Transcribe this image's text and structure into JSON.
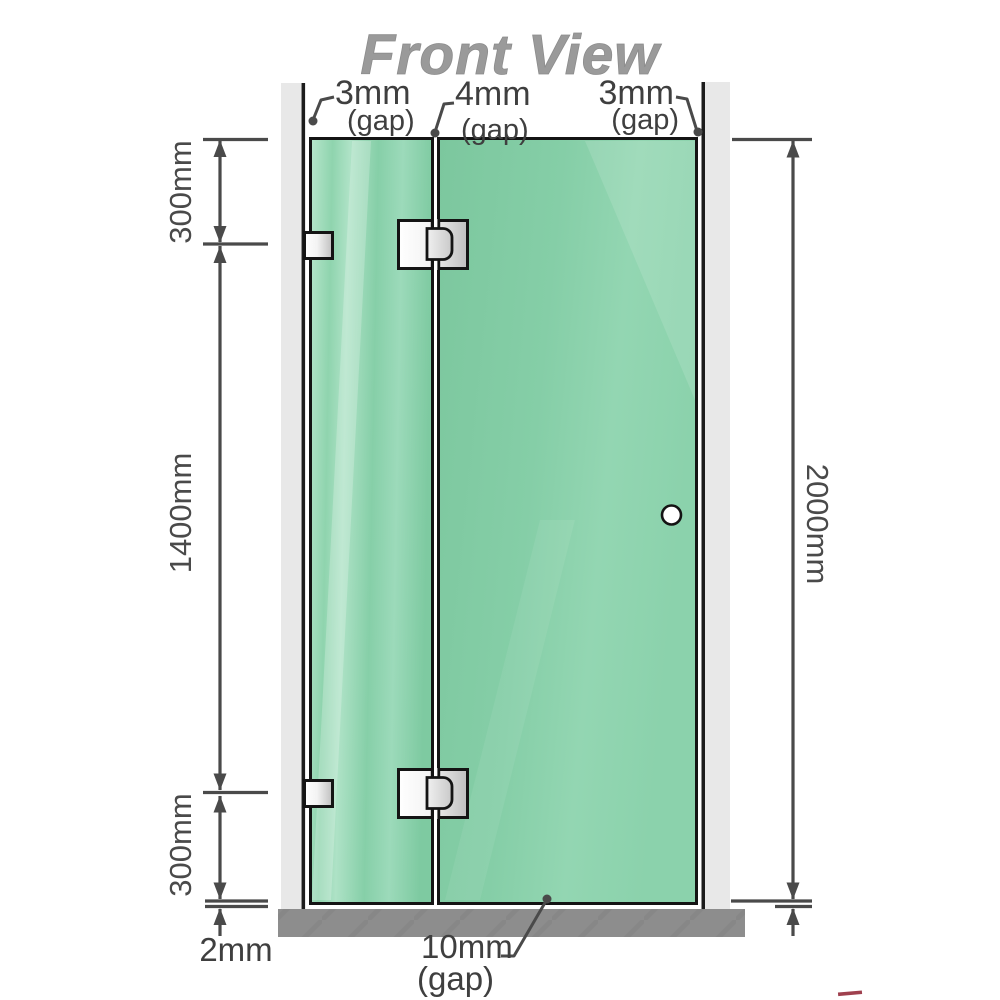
{
  "title": "Front View",
  "annotations": {
    "gap_top_left": {
      "value": "3mm",
      "note": "(gap)"
    },
    "gap_top_middle": {
      "value": "4mm",
      "note": "(gap)"
    },
    "gap_top_right": {
      "value": "3mm",
      "note": "(gap)"
    },
    "gap_bottom_door": {
      "value": "10mm",
      "note": "(gap)"
    },
    "floor_clearance": {
      "value": "2mm"
    }
  },
  "dimensions": {
    "top_section": "300mm",
    "middle_section": "1400mm",
    "bottom_section": "300mm",
    "overall_height": "2000mm"
  },
  "components": {
    "left_wall": "wall",
    "right_wall": "wall",
    "fixed_glass_panel": "hinged fixed panel",
    "door_glass_panel": "door panel",
    "door_knob": "round knob",
    "wall_bracket_count": 2,
    "glass_hinge_count": 2,
    "floor": "floor base strip"
  },
  "colors": {
    "glass_green": "#84cda6",
    "glass_highlight": "#b7e6cc",
    "wall_gray": "#e8e8e8",
    "wall_edge_black": "#1c1c1c",
    "floor_gray": "#8d8d8d",
    "dimension_line": "#4a4a4a",
    "title_gray": "#9a9a9a",
    "metal_light": "#ffffff",
    "metal_dark": "#bfbfbf",
    "watermark_red": "#8e1f2f"
  }
}
